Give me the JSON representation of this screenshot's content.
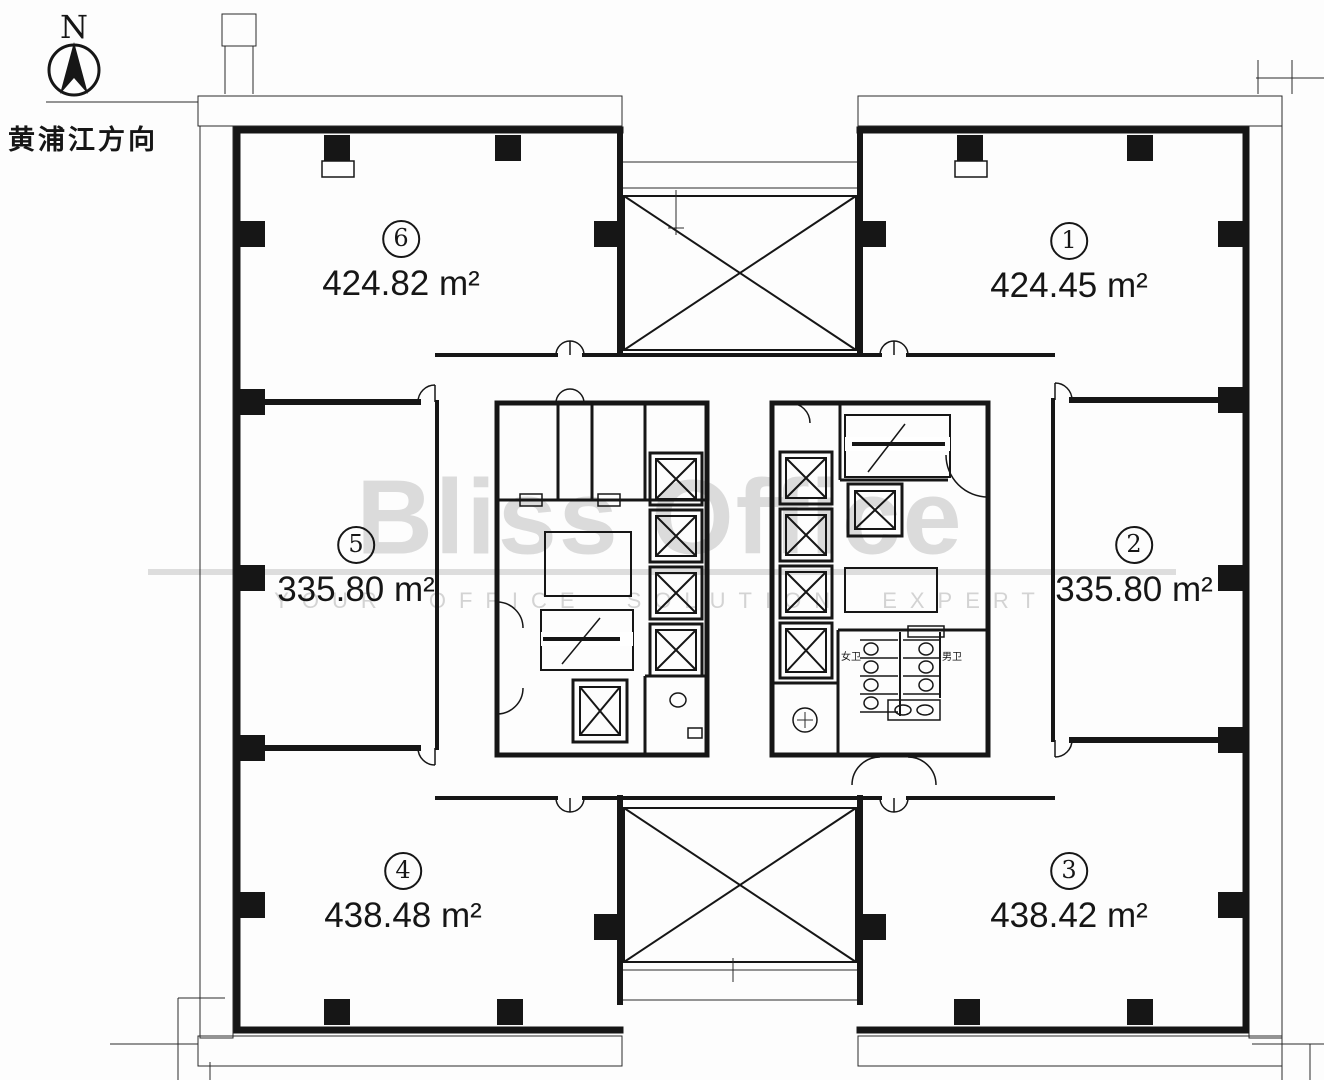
{
  "compass": {
    "north_letter": "N",
    "direction_label": "黄浦江方向"
  },
  "watermark": {
    "brand": "Bliss Office",
    "tagline": "YOUR OFFICE SOLUTION EXPERT"
  },
  "units": [
    {
      "number": "1",
      "area": "424.45 m²"
    },
    {
      "number": "2",
      "area": "335.80 m²"
    },
    {
      "number": "3",
      "area": "438.42 m²"
    },
    {
      "number": "4",
      "area": "438.48 m²"
    },
    {
      "number": "5",
      "area": "335.80 m²"
    },
    {
      "number": "6",
      "area": "424.82 m²"
    }
  ],
  "core_labels": {
    "female_wc": "女卫",
    "male_wc": "男卫"
  },
  "colors": {
    "ink": "#161616",
    "watermark_gray": "#c7c7c7",
    "background": "#fdfdfd"
  }
}
